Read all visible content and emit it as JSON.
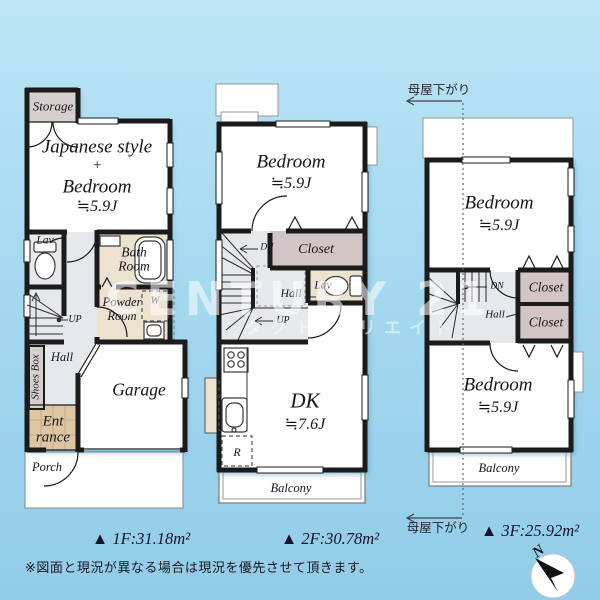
{
  "colors": {
    "background_top": "#bce4f5",
    "background_bottom": "#92cce8",
    "wall": "#1b1b1b",
    "closet_fill": "#d1c5c5",
    "wet_room_fill": "#ece2d0",
    "hall_fill": "#e7e8ec",
    "storage_fill": "#d7cfce",
    "entrance_fill": "#ddc6a2",
    "watermark": "#ffffff"
  },
  "watermark": {
    "brand": "CENTURY 21",
    "sub": "タクト クリエイト"
  },
  "compass": {
    "north": "N"
  },
  "note": "※図面と現況が異なる場合は現況を優先させて頂きます。",
  "f1": {
    "area": "▲ 1F:31.18m²",
    "storage": "Storage",
    "jp_l1": "Japanese style",
    "jp_l2": "+",
    "jp_l3": "Bedroom",
    "jp_l4": "≒5.9J",
    "lav": "Lav",
    "bath_l1": "Bath",
    "bath_l2": "Room",
    "powder_l1": "Powder",
    "powder_l2": "Room",
    "washer": "W",
    "up": "UP",
    "hall": "Hall",
    "shoes_box": "Shoes Box",
    "ent_l1": "Ent",
    "ent_l2": "rance",
    "garage": "Garage",
    "porch": "Porch"
  },
  "f2": {
    "area": "▲ 2F:30.78m²",
    "bedroom_l1": "Bedroom",
    "bedroom_l2": "≒5.9J",
    "closet": "Closet",
    "dn": "DN",
    "hall": "Hall",
    "up": "UP",
    "lav": "Lav",
    "dk_l1": "DK",
    "dk_l2": "≒7.6J",
    "fridge": "R",
    "balcony": "Balcony"
  },
  "f3": {
    "area": "▲ 3F:25.92m²",
    "moya_top": "母屋下がり",
    "moya_bottom": "母屋下がり",
    "bedroom1_l1": "Bedroom",
    "bedroom1_l2": "≒5.9J",
    "closet1": "Closet",
    "closet2": "Closet",
    "dn": "DN",
    "hall": "Hall",
    "bedroom2_l1": "Bedroom",
    "bedroom2_l2": "≒5.9J",
    "balcony": "Balcony"
  }
}
